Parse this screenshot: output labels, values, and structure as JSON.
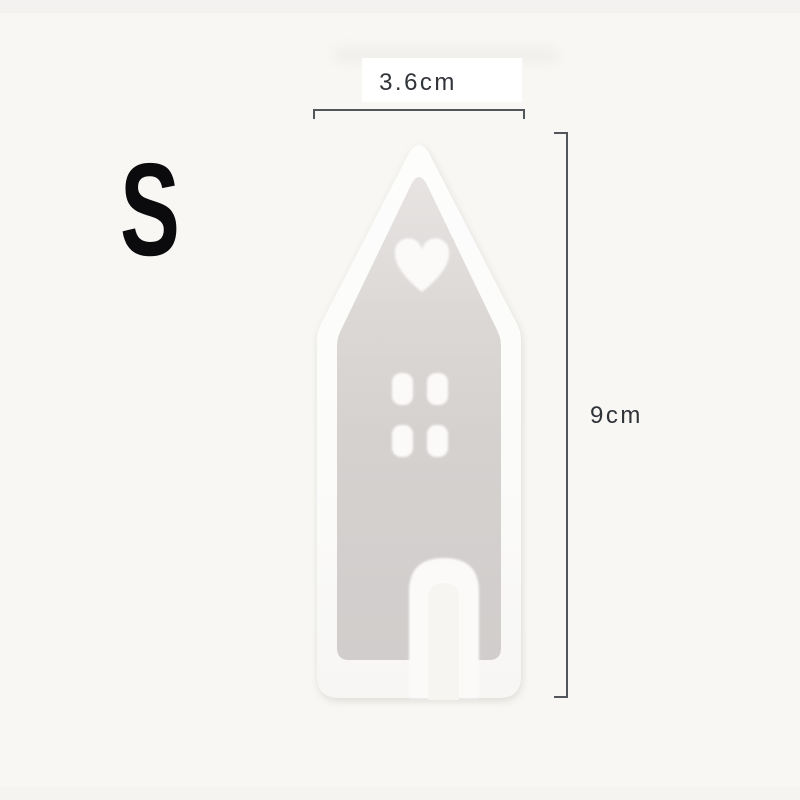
{
  "size_label": "S",
  "dimensions": {
    "width": "3.6cm",
    "height": "9cm"
  },
  "figure": {
    "subject": "house-shaped-silicone-mold",
    "shapes": [
      "heart-cutout",
      "window-holes",
      "door-slot"
    ]
  },
  "colors": {
    "background": "#f8f7f4",
    "mold_white": "#fcfcfb",
    "cavity_gray": "#d7d3d1",
    "measure_line": "#52565a",
    "dimension_text": "#303338",
    "size_label": "#0b0b0d"
  }
}
